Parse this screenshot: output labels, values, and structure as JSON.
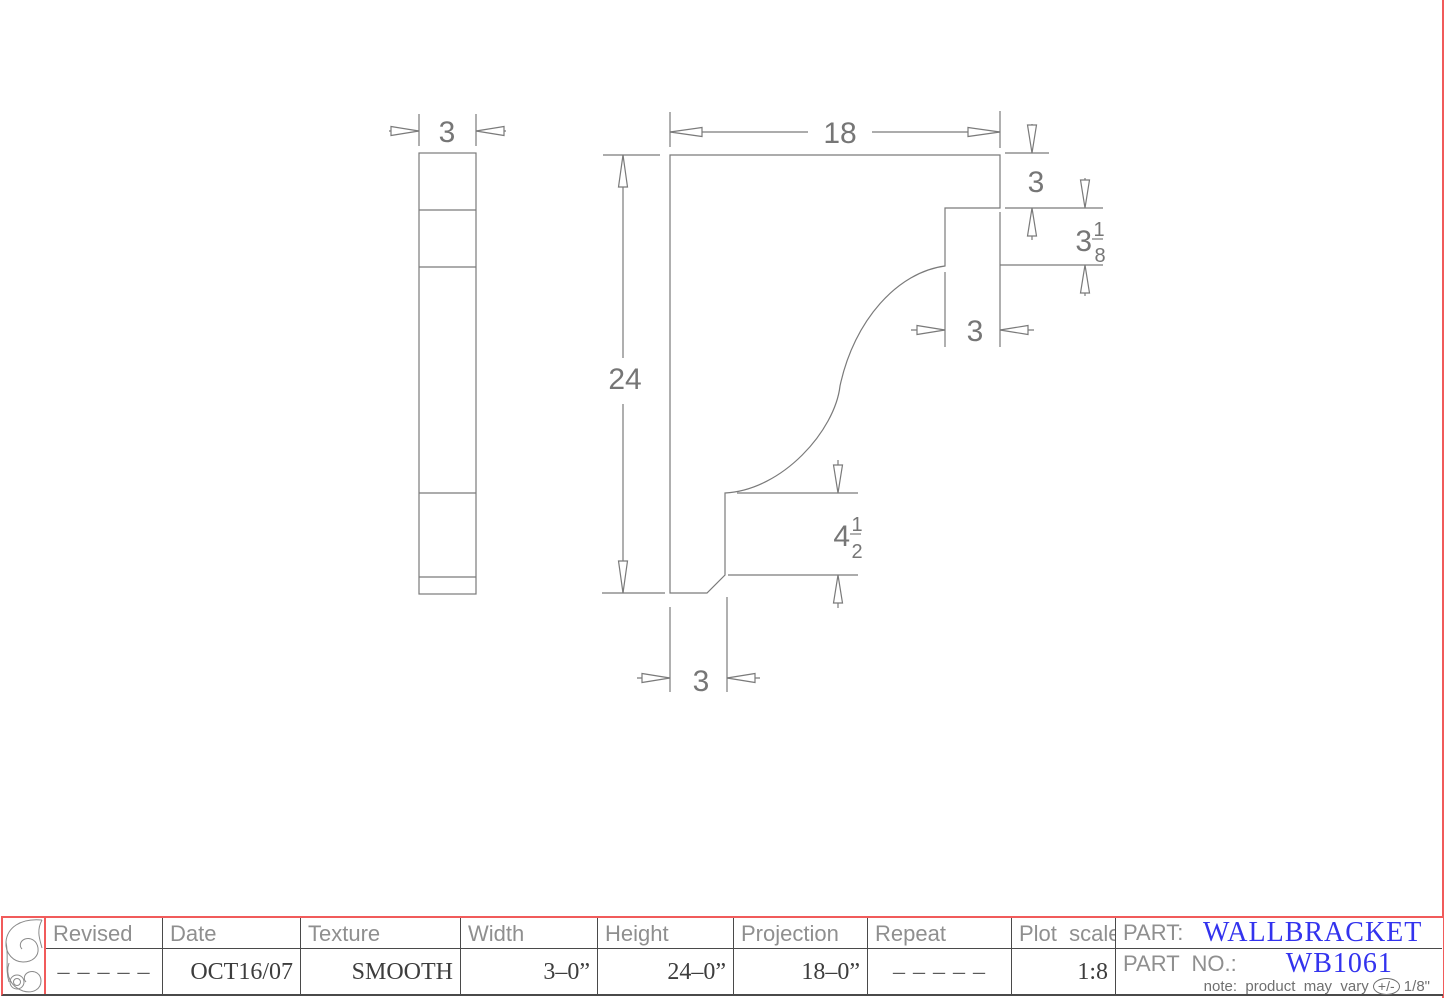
{
  "drawing": {
    "dims": {
      "thickness": "3",
      "projection": "18",
      "height": "24",
      "arm_depth": "3",
      "step_whole": "3",
      "step_num": "1",
      "step_den": "8",
      "notch_width": "3",
      "base_whole": "4",
      "base_num": "1",
      "base_den": "2",
      "leg_width": "3"
    }
  },
  "title_block": {
    "columns": [
      {
        "label": "Revised",
        "value": "– – – – –"
      },
      {
        "label": "Date",
        "value": "OCT16/07"
      },
      {
        "label": "Texture",
        "value": "SMOOTH"
      },
      {
        "label": "Width",
        "value": "3–0”"
      },
      {
        "label": "Height",
        "value": "24–0”"
      },
      {
        "label": "Projection",
        "value": "18–0”"
      },
      {
        "label": "Repeat",
        "value": "– – – – –"
      },
      {
        "label": "Plot  scale",
        "value": "1:8"
      }
    ],
    "part_label": "PART:",
    "part_value": "WALLBRACKET",
    "part_no_label": "PART  NO.:",
    "part_no_value": "WB1061",
    "note_prefix": "note:  product  may  vary ",
    "note_pm": "+/-",
    "note_suffix": " 1/8\""
  },
  "colors": {
    "frame_red": "#f15b5b",
    "accent_blue": "#3333ee",
    "line_gray": "#7a7a7a"
  }
}
